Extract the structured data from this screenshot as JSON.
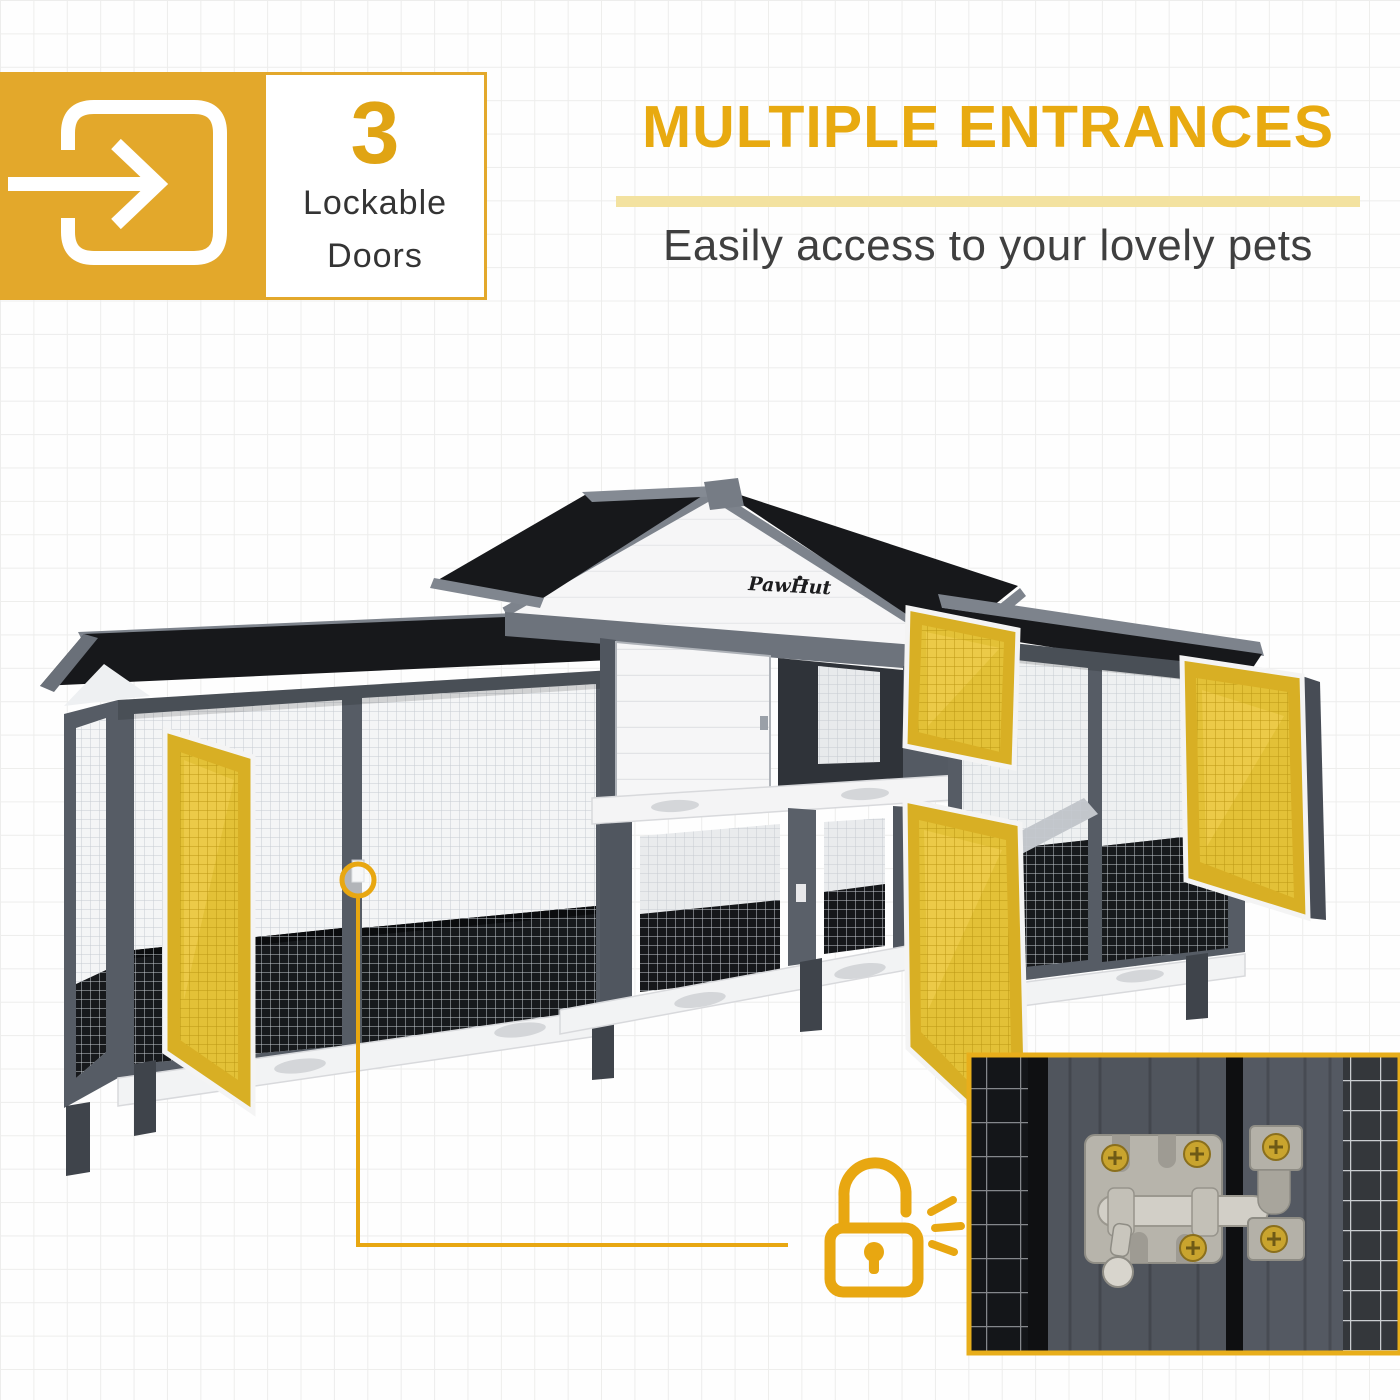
{
  "badge": {
    "icon_name": "door-enter-arrow-icon",
    "number": "3",
    "label_line1": "Lockable",
    "label_line2": "Doors"
  },
  "header": {
    "title": "MULTIPLE ENTRANCES",
    "subtitle": "Easily access to your lovely pets"
  },
  "product": {
    "brand_logo": "PawHut",
    "subject": "pet-hutch-with-highlighted-mesh-doors",
    "highlighted_door_count": 4
  },
  "callout": {
    "icon_name": "open-padlock-icon",
    "marker_name": "door-latch-marker"
  },
  "inset": {
    "content_name": "slide-bolt-latch-closeup"
  },
  "colors": {
    "accent_yellow": "#E3A82B",
    "heading_yellow": "#E8AA10",
    "underline_pale_yellow": "#F3E2A0",
    "number_yellow": "#E0A414",
    "text_dark": "#3C3C3C",
    "door_highlight_yellow": "#D8AF24",
    "callout_yellow": "#E8A711",
    "inset_border_yellow": "#E8AE1B",
    "roof_black": "#17181B",
    "frame_gray": "#565C65"
  }
}
